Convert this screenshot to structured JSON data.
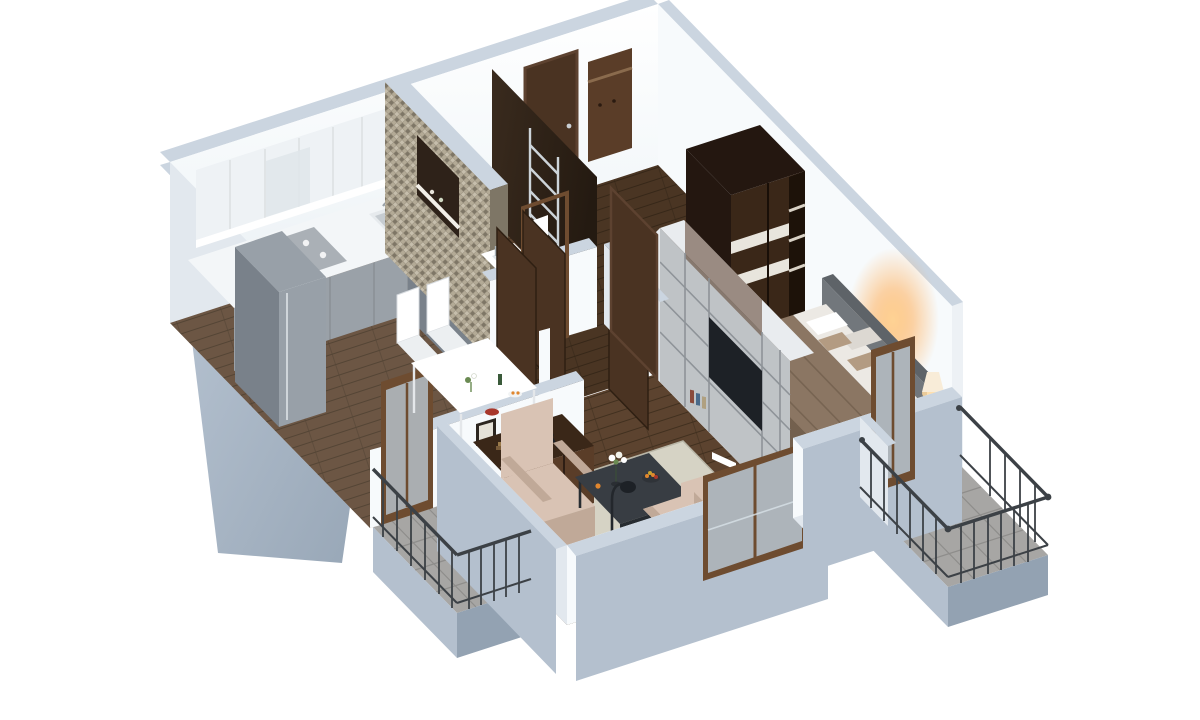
{
  "scene": {
    "type": "3d-floorplan-render",
    "style": "isometric dollhouse cutaway of a one-bedroom apartment, white background",
    "view": "aerial from south-west",
    "background": "#ffffff"
  },
  "rooms": [
    {
      "id": "kitchen-dining",
      "label": "kitchen and dining area",
      "furniture": [
        "gray-front kitchen cabinets with white counter",
        "white upper cabinets with under-cabinet light",
        "patterned cooktop",
        "inset sink",
        "toaster",
        "dishwasher panel",
        "tall gray refrigerator",
        "tall gray cabinet column",
        "white dining table",
        "two white chairs",
        "flower sprig, bottle and fruit plate",
        "red bowl on half wall"
      ]
    },
    {
      "id": "bathroom",
      "label": "bathroom",
      "furniture": [
        "tall mosaic accent wall with lit niche and shelf",
        "white washbasin on dark cabinet",
        "toilet",
        "chrome towel ladder on dark wall"
      ]
    },
    {
      "id": "entry-hall",
      "label": "entry hall",
      "furniture": [
        "dark brown entrance door with metal handle",
        "brown coat rack with shelf",
        "open dark interior doors",
        "dark wood floor"
      ]
    },
    {
      "id": "bedroom",
      "label": "bedroom",
      "furniture": [
        "double bed with white sheets and brown throw",
        "tan accent cushions",
        "gray upholstered headboard bench",
        "dark sliding wardrobe with white stripes and open shelf end",
        "brown nightstand",
        "glowing table lamp with warm light on wall",
        "open balcony door"
      ]
    },
    {
      "id": "living-room",
      "label": "living room",
      "furniture": [
        "long gray shelving media unit with dark TV panel, books and magazines",
        "dark brown back panel",
        "two pale beige armchairs",
        "beige two-seat sofa",
        "dark coffee table with white flower bouquet and fruit bowl",
        "black floor lamp",
        "dark sideboard with red vases, books, desk lamp",
        "two framed pictures on wall",
        "beige area rug",
        "brown framed panoramic window"
      ]
    },
    {
      "id": "balcony-west",
      "label": "west balcony off dining",
      "furniture": [
        "gray tile floor",
        "dark metal railing",
        "brown framed glass door"
      ]
    },
    {
      "id": "balcony-southeast",
      "label": "south-east balcony off bedroom",
      "furniture": [
        "gray tile floor",
        "dark metal railing with wall brackets"
      ]
    }
  ],
  "colors": {
    "background": "#ffffff",
    "wall_exterior": "#b4c0ce",
    "wall_exterior_dark": "#93a2b2",
    "wall_top": "#cbd5e0",
    "wall_interior": "#f7fafc",
    "wall_interior_shadow": "#e2e8ee",
    "wall_east_ext": "#edf1f5",
    "wood_mid": "#5c432f",
    "wood_line": "#41301f",
    "tile": "#a7a6a4",
    "tile_line": "#8e8d8b",
    "rug": "#d6d3c5",
    "cabinet_gray": "#9aa1a8",
    "cabinet_gray_dark": "#7a828a",
    "counter_white": "#f3f6f8",
    "cabinet_upper": "#eef2f5",
    "fridge": "#98a0a8",
    "fridge_side": "#79818a",
    "cooktop": "#aab0b6",
    "espresso": "#3a2718",
    "espresso_dark": "#241710",
    "espresso_light": "#5a3d28",
    "door_brown": "#4a3322",
    "frame_brown": "#6e4c30",
    "glass": "#b9c7d2",
    "mosaic_a": "#b3aa96",
    "mosaic_b": "#9b9280",
    "mosaic_c": "#c6beac",
    "mosaic_d": "#7e7666",
    "unit_gray": "#bfc3c6",
    "unit_gray_dark": "#a8adb2",
    "unit_white": "#e9ecef",
    "tv_black": "#1d2126",
    "sofa_gray": "#72777c",
    "sofa_gray_dark": "#5e6368",
    "bed_blanket": "#8b7663",
    "bed_blanket_dark": "#73604e",
    "bed_sheet": "#ece9e4",
    "pillow_tan": "#b39b82",
    "armchair": "#d9c3b4",
    "armchair_dark": "#c0a998",
    "table_dark": "#383d43",
    "table_dark_edge": "#272c31",
    "railing": "#3c4146",
    "accent_red": "#a8372b",
    "accent_orange": "#e0862e",
    "accent_green": "#6a8a52",
    "lamp_glow": "#ffb347",
    "lamp_shade": "#f8ecd8",
    "chrome": "#cdd4d9",
    "white": "#ffffff"
  }
}
